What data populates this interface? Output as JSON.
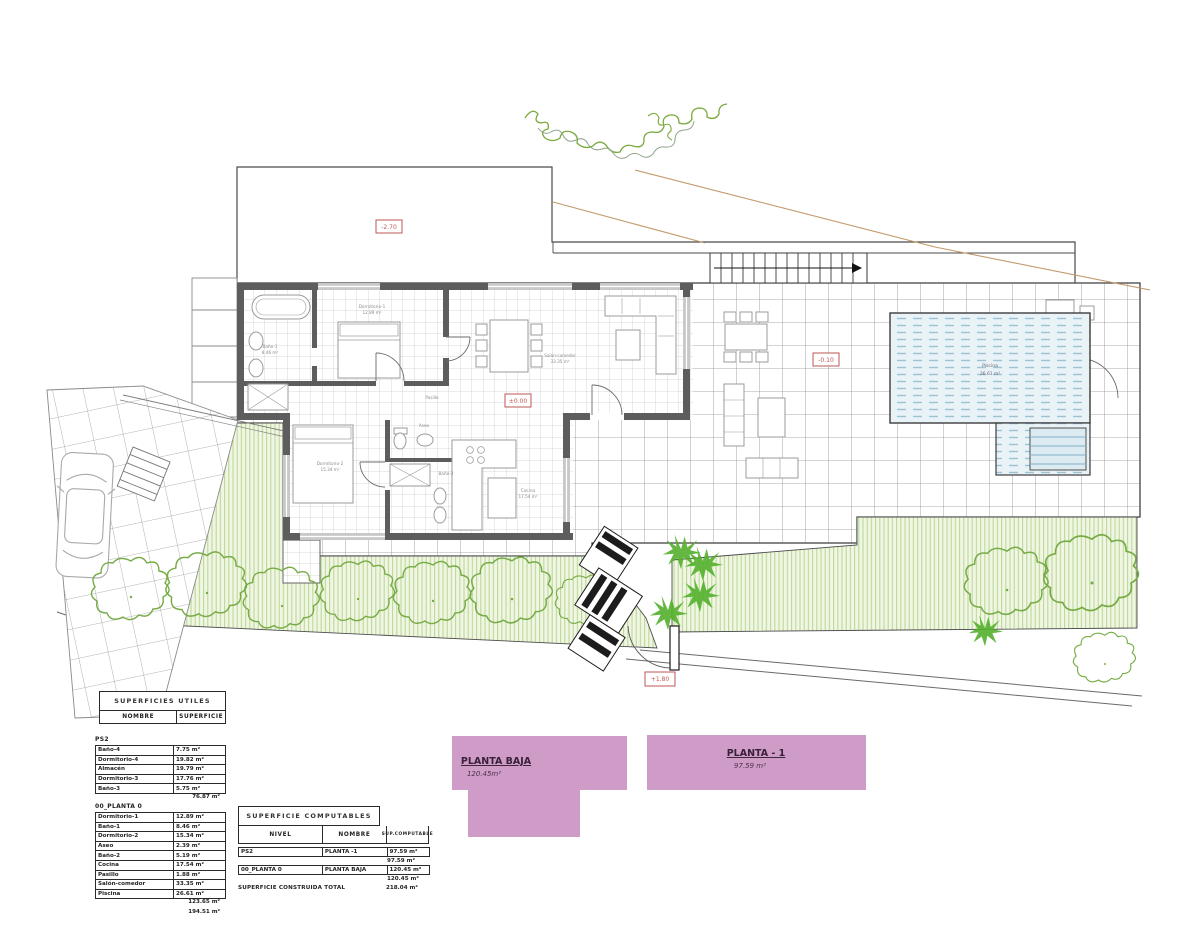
{
  "plan": {
    "elevation_labels": {
      "upper_plot": "-2.70",
      "house_zero": "±0.00",
      "terrace": "-0.10",
      "garden_gate": "+1.80"
    },
    "room_labels": {
      "bano1": "Baño-1",
      "bano1_area": "8.46 m²",
      "dormitorio1": "Dormitorio-1",
      "dormitorio1_area": "12.89 m²",
      "salon": "Salón-comedor",
      "salon_area": "33.35 m²",
      "pasillo": "Pasillo",
      "aseo": "Aseo",
      "bano2": "Baño-2",
      "cocina": "Cocina",
      "cocina_area": "17.54 m²",
      "dormitorio2": "Dormitorio-2",
      "dormitorio2_area": "15.34 m²",
      "piscina": "Piscina",
      "piscina_area": "26.61 m²"
    }
  },
  "legend_shapes": {
    "planta_baja": {
      "title": "PLANTA BAJA",
      "area": "120.45m²"
    },
    "planta_m1": {
      "title": "PLANTA - 1",
      "area": "97.59 m²"
    }
  },
  "tables": {
    "utiles": {
      "title": "SUPERFICIES UTILES",
      "col_name": "NOMBRE",
      "col_area": "SUPERFICIE",
      "sections": [
        {
          "label": "PS2",
          "rows": [
            [
              "Baño-4",
              "7.75 m²"
            ],
            [
              "Dormitorio-4",
              "19.82 m²"
            ],
            [
              "Almacén",
              "19.79 m²"
            ],
            [
              "Dormitorio-3",
              "17.76 m²"
            ],
            [
              "Baño-3",
              "5.75 m²"
            ]
          ],
          "total": "76.87 m²"
        },
        {
          "label": "00_PLANTA 0",
          "rows": [
            [
              "Dormitorio-1",
              "12.89 m²"
            ],
            [
              "Baño-1",
              "8.46 m²"
            ],
            [
              "Dormitorio-2",
              "15.34 m²"
            ],
            [
              "Aseo",
              "2.39 m²"
            ],
            [
              "Baño-2",
              "5.19 m²"
            ],
            [
              "Cocina",
              "17.54 m²"
            ],
            [
              "Pasillo",
              "1.88 m²"
            ],
            [
              "Salón-comedor",
              "33.35 m²"
            ],
            [
              "Piscina",
              "26.61 m²"
            ]
          ],
          "total": "123.65 m²",
          "grand_total": "194.51 m²"
        }
      ]
    },
    "computables": {
      "title": "SUPERFICIE COMPUTABLES",
      "col_nivel": "NIVEL",
      "col_nombre": "NOMBRE",
      "col_sup": "SUP.COMPUTABLE",
      "rows": [
        [
          "PS2",
          "PLANTA -1",
          "97.59 m²",
          "97.59 m²"
        ],
        [
          "00_PLANTA 0",
          "PLANTA BAJA",
          "120.45 m²",
          "120.45 m²"
        ]
      ],
      "total_label": "SUPERFICIE CONSTRUIDA TOTAL",
      "total_value": "218.04 m²"
    }
  },
  "colors": {
    "wall": "#5d5d5d",
    "grid": "#909090",
    "garden_hatch": "#b7d692",
    "tree": "#76ab45",
    "pool_line": "#9cc2d4",
    "elevation_red": "#bf5654",
    "plan_pink": "#cf9cc8",
    "terrain_tan": "#c49a6c"
  }
}
